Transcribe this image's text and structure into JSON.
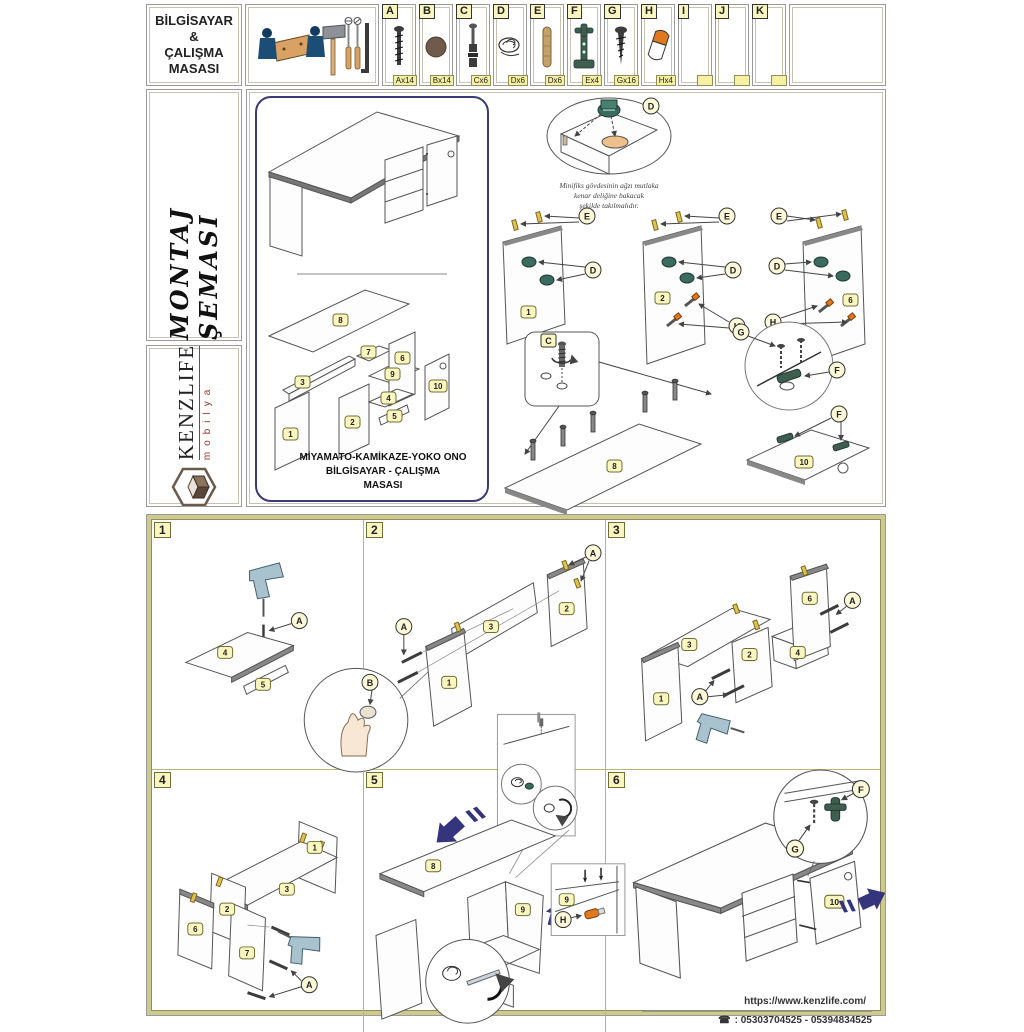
{
  "header": {
    "title_lines": [
      "BİLGİSAYAR",
      "&",
      "ÇALIŞMA",
      "MASASI"
    ],
    "parts": [
      {
        "letter": "A",
        "qty": "Ax14",
        "icon": "screw-icon"
      },
      {
        "letter": "B",
        "qty": "Bx14",
        "icon": "cover-cap-icon"
      },
      {
        "letter": "C",
        "qty": "Cx6",
        "icon": "minifix-bolt-icon"
      },
      {
        "letter": "D",
        "qty": "Dx6",
        "icon": "cam-lock-icon"
      },
      {
        "letter": "E",
        "qty": "Dx6",
        "icon": "wooden-dowel-icon"
      },
      {
        "letter": "F",
        "qty": "Ex4",
        "icon": "hinge-icon"
      },
      {
        "letter": "G",
        "qty": "Gx16",
        "icon": "screw-icon"
      },
      {
        "letter": "H",
        "qty": "Hx4",
        "icon": "cap-icon"
      },
      {
        "letter": "I",
        "qty": "",
        "icon": ""
      },
      {
        "letter": "J",
        "qty": "",
        "icon": ""
      },
      {
        "letter": "K",
        "qty": "",
        "icon": ""
      }
    ]
  },
  "sidebar": {
    "schema_title": "MONTAJ ŞEMASI",
    "brand": "KENZLIFE",
    "brand_sub": "mobilya"
  },
  "overview": {
    "product_name_line1": "MİYAMATO-KAMİKAZE-YOKO ONO",
    "product_name_line2": "BİLGİSAYAR - ÇALIŞMA",
    "product_name_line3": "MASASI",
    "note_line1": "Minifiks gövdesinin ağzı mutlaka",
    "note_line2": "kenar deliğine bakacak",
    "note_line3": "şekilde takılmalıdır."
  },
  "nums": [
    "1",
    "2",
    "3",
    "4",
    "5",
    "6",
    "7",
    "8",
    "9",
    "10"
  ],
  "callouts": {
    "A": "A",
    "B": "B",
    "C": "C",
    "D": "D",
    "E": "E",
    "F": "F",
    "G": "G",
    "H": "H"
  },
  "steps": [
    {
      "num": "1"
    },
    {
      "num": "2"
    },
    {
      "num": "3"
    },
    {
      "num": "4"
    },
    {
      "num": "5"
    },
    {
      "num": "6"
    }
  ],
  "footer": {
    "website": "https://www.kenzlife.com/",
    "phone": ": 05303704525 - 05394834525",
    "phone_icon": "☎"
  },
  "colors": {
    "accent_navy": "#3a3a78",
    "tag_yellow": "#fbf6c0",
    "khaki_frame": "#cdc98f",
    "cam_teal": "#3a6b5e",
    "cap_orange": "#e07820",
    "dowel_yellow": "#e2c24a",
    "wood_tan": "#c4a167"
  }
}
